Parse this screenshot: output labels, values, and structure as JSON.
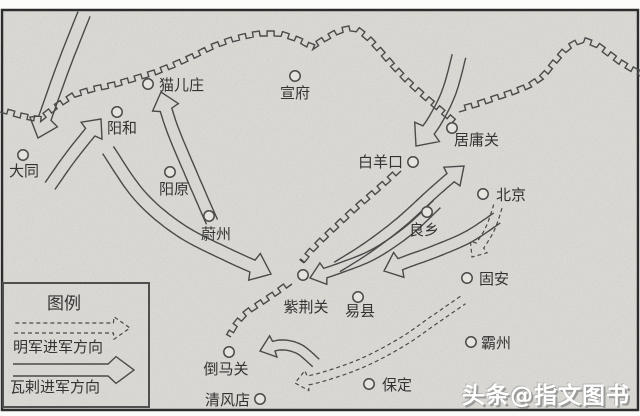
{
  "map": {
    "background_color": "#dbd9d4",
    "line_color": "#4a4a4a",
    "border_color": "#2d2d2d",
    "cities": [
      {
        "name": "大同",
        "x": 23,
        "y": 155,
        "lx": 24,
        "ly": 176,
        "anchor": "middle"
      },
      {
        "name": "阳和",
        "x": 117,
        "y": 112,
        "lx": 122,
        "ly": 133,
        "anchor": "middle"
      },
      {
        "name": "猫儿庄",
        "x": 148,
        "y": 84,
        "lx": 159,
        "ly": 90,
        "anchor": "start"
      },
      {
        "name": "宣府",
        "x": 295,
        "y": 76,
        "lx": 295,
        "ly": 98,
        "anchor": "middle"
      },
      {
        "name": "阳原",
        "x": 170,
        "y": 172,
        "lx": 174,
        "ly": 194,
        "anchor": "middle"
      },
      {
        "name": "蔚州",
        "x": 209,
        "y": 216,
        "lx": 216,
        "ly": 239,
        "anchor": "middle"
      },
      {
        "name": "白羊口",
        "x": 413,
        "y": 162,
        "lx": 403,
        "ly": 167,
        "anchor": "end"
      },
      {
        "name": "居庸关",
        "x": 452,
        "y": 128,
        "lx": 454,
        "ly": 145,
        "anchor": "start"
      },
      {
        "name": "北京",
        "x": 483,
        "y": 194,
        "lx": 496,
        "ly": 200,
        "anchor": "start"
      },
      {
        "name": "良乡",
        "x": 427,
        "y": 212,
        "lx": 424,
        "ly": 235,
        "anchor": "middle"
      },
      {
        "name": "固安",
        "x": 467,
        "y": 278,
        "lx": 479,
        "ly": 284,
        "anchor": "start"
      },
      {
        "name": "紫荆关",
        "x": 303,
        "y": 275,
        "lx": 306,
        "ly": 312,
        "anchor": "middle"
      },
      {
        "name": "易县",
        "x": 358,
        "y": 297,
        "lx": 360,
        "ly": 316,
        "anchor": "middle"
      },
      {
        "name": "霸州",
        "x": 471,
        "y": 342,
        "lx": 481,
        "ly": 348,
        "anchor": "start"
      },
      {
        "name": "保定",
        "x": 369,
        "y": 384,
        "lx": 382,
        "ly": 390,
        "anchor": "start"
      },
      {
        "name": "倒马关",
        "x": 229,
        "y": 352,
        "lx": 226,
        "ly": 374,
        "anchor": "middle"
      },
      {
        "name": "清风店",
        "x": 260,
        "y": 399,
        "lx": 250,
        "ly": 405,
        "anchor": "end"
      }
    ],
    "walls": [
      {
        "name": "outer-great-wall-west",
        "side": -1,
        "pts": [
          [
            0,
            112
          ],
          [
            20,
            118
          ],
          [
            40,
            122
          ],
          [
            58,
            108
          ],
          [
            75,
            97
          ],
          [
            95,
            91
          ],
          [
            115,
            87
          ],
          [
            135,
            81
          ],
          [
            155,
            75
          ],
          [
            175,
            67
          ],
          [
            195,
            58
          ],
          [
            215,
            48
          ],
          [
            235,
            41
          ],
          [
            258,
            36
          ],
          [
            280,
            36
          ],
          [
            298,
            42
          ],
          [
            312,
            50
          ],
          [
            324,
            42
          ],
          [
            340,
            33
          ],
          [
            354,
            30
          ],
          [
            366,
            39
          ],
          [
            378,
            52
          ],
          [
            390,
            66
          ],
          [
            404,
            81
          ],
          [
            418,
            94
          ],
          [
            432,
            106
          ],
          [
            444,
            116
          ],
          [
            452,
            123
          ]
        ]
      },
      {
        "name": "outer-great-wall-east",
        "side": -1,
        "pts": [
          [
            459,
            112
          ],
          [
            476,
            107
          ],
          [
            494,
            101
          ],
          [
            512,
            95
          ],
          [
            530,
            88
          ],
          [
            545,
            78
          ],
          [
            556,
            64
          ],
          [
            568,
            50
          ],
          [
            582,
            42
          ],
          [
            596,
            47
          ],
          [
            608,
            56
          ],
          [
            620,
            65
          ],
          [
            632,
            72
          ],
          [
            640,
            76
          ]
        ]
      },
      {
        "name": "inner-great-wall-north",
        "side": 1,
        "pts": [
          [
            401,
            171
          ],
          [
            386,
            185
          ],
          [
            371,
            198
          ],
          [
            356,
            211
          ],
          [
            341,
            225
          ],
          [
            326,
            239
          ],
          [
            313,
            252
          ],
          [
            304,
            263
          ]
        ]
      },
      {
        "name": "inner-great-wall-south",
        "side": 1,
        "pts": [
          [
            292,
            284
          ],
          [
            277,
            295
          ],
          [
            262,
            305
          ],
          [
            248,
            314
          ],
          [
            238,
            325
          ],
          [
            231,
            337
          ]
        ]
      }
    ],
    "arrows": [
      {
        "name": "oirat-arrow-north-to-datong",
        "type": "oirat",
        "w": 13,
        "head": 17,
        "pts": [
          [
            84,
            14
          ],
          [
            62,
            70
          ],
          [
            38,
            138
          ]
        ]
      },
      {
        "name": "oirat-arrow-datong-to-yanghe",
        "type": "oirat",
        "w": 12,
        "head": 15,
        "pts": [
          [
            50,
            186
          ],
          [
            72,
            155
          ],
          [
            101,
            119
          ]
        ]
      },
      {
        "name": "oirat-arrow-south-to-maoerzhuang",
        "type": "oirat",
        "w": 12,
        "head": 16,
        "pts": [
          [
            212,
            222
          ],
          [
            192,
            176
          ],
          [
            172,
            128
          ],
          [
            161,
            92
          ]
        ]
      },
      {
        "name": "oirat-arrow-yanghe-to-zijingguan",
        "type": "oirat",
        "w": 13,
        "head": 18,
        "pts": [
          [
            108,
            150
          ],
          [
            140,
            196
          ],
          [
            180,
            230
          ],
          [
            228,
            255
          ],
          [
            271,
            274
          ]
        ]
      },
      {
        "name": "oirat-arrow-north-to-baiyangkou",
        "type": "oirat",
        "w": 14,
        "head": 18,
        "pts": [
          [
            459,
            56
          ],
          [
            449,
            92
          ],
          [
            434,
            122
          ],
          [
            416,
            146
          ]
        ]
      },
      {
        "name": "oirat-arrow-zijingguan-to-juyongguan",
        "type": "oirat",
        "w": 11,
        "head": 16,
        "pts": [
          [
            337,
            267
          ],
          [
            367,
            248
          ],
          [
            400,
            223
          ],
          [
            433,
            193
          ],
          [
            464,
            166
          ]
        ]
      },
      {
        "name": "oirat-arrow-liangxiang-to-yixian",
        "type": "oirat",
        "w": 12,
        "head": 16,
        "pts": [
          [
            497,
            218
          ],
          [
            468,
            237
          ],
          [
            436,
            251
          ],
          [
            406,
            262
          ],
          [
            384,
            271
          ]
        ]
      },
      {
        "name": "oirat-arrow-beijing-to-zijingguan",
        "type": "oirat",
        "w": 10,
        "head": 14,
        "pts": [
          [
            437,
            204
          ],
          [
            408,
            231
          ],
          [
            374,
            254
          ],
          [
            340,
            268
          ],
          [
            310,
            278
          ]
        ]
      },
      {
        "name": "oirat-arrow-to-daomaguan",
        "type": "oirat",
        "w": 10,
        "head": 14,
        "pts": [
          [
            316,
            363
          ],
          [
            299,
            349
          ],
          [
            280,
            345
          ],
          [
            260,
            351
          ]
        ]
      },
      {
        "name": "ming-arrow-beijing-to-guan",
        "type": "ming",
        "w": 9,
        "head": 12,
        "pts": [
          [
            498,
            206
          ],
          [
            489,
            231
          ],
          [
            472,
            257
          ]
        ]
      },
      {
        "name": "ming-arrow-guan-to-daomaguan",
        "type": "ming",
        "w": 9,
        "head": 12,
        "pts": [
          [
            463,
            300
          ],
          [
            434,
            320
          ],
          [
            402,
            342
          ],
          [
            362,
            363
          ],
          [
            322,
            377
          ],
          [
            295,
            383
          ]
        ]
      }
    ]
  },
  "legend": {
    "title": "图例",
    "box": {
      "x": 3,
      "y": 283,
      "w": 146,
      "h": 124
    },
    "title_x": 64,
    "title_y": 309,
    "items": [
      {
        "label": "明军进军方向",
        "type": "ming",
        "arrow": {
          "w": 10,
          "head": 16,
          "pts": [
            [
              14,
              328
            ],
            [
              130,
              328
            ]
          ]
        },
        "label_x": 13,
        "label_y": 352
      },
      {
        "label": "瓦剌进军方向",
        "type": "oirat",
        "arrow": {
          "w": 12,
          "head": 18,
          "pts": [
            [
              13,
              370
            ],
            [
              134,
              370
            ]
          ]
        },
        "label_x": 10,
        "label_y": 392
      }
    ]
  },
  "watermark": {
    "text": "头条@指文图书"
  }
}
